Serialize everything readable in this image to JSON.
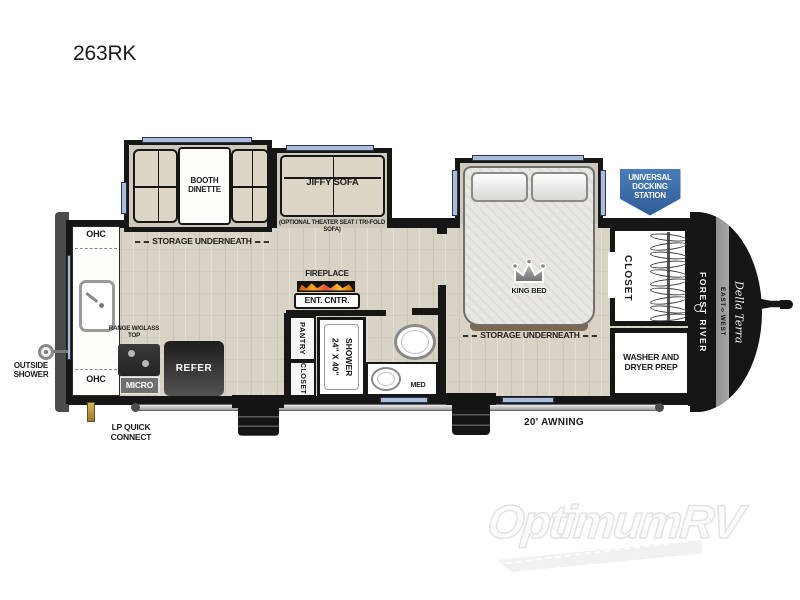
{
  "page": {
    "title": "263RK"
  },
  "watermark": {
    "brand": "OptimumRV"
  },
  "exterior": {
    "docking_station": "UNIVERSAL DOCKING STATION",
    "awning": "20' AWNING",
    "outside_shower": "OUTSIDE SHOWER",
    "lp_quick_connect": "LP QUICK CONNECT"
  },
  "living_area": {
    "booth_dinette": "BOOTH DINETTE",
    "storage_underneath": "STORAGE UNDERNEATH",
    "jiffy_sofa": "JIFFY SOFA",
    "optional_note": "(OPTIONAL THEATER SEAT / TRI-FOLD SOFA)",
    "fireplace": "FIREPLACE",
    "ent_cntr": "ENT. CNTR."
  },
  "kitchen": {
    "ohc_top": "OHC",
    "ohc_bottom": "OHC",
    "range": "RANGE W/GLASS TOP",
    "micro": "MICRO",
    "refer": "REFER"
  },
  "bathroom": {
    "pantry": "PANTRY",
    "closet": "CLOSET",
    "shower": "24\" X 40\" SHOWER",
    "med": "MED"
  },
  "bedroom": {
    "king_bed": "KING BED",
    "storage_underneath": "STORAGE UNDERNEATH",
    "closet": "CLOSET",
    "washer_dryer": "WASHER AND DRYER PREP"
  },
  "branding": {
    "manufacturer": "FOREST RIVER",
    "division": "EAST◊WEST",
    "series": "Della Terra"
  },
  "colors": {
    "badge_blue": "#3d6eac",
    "window_blue": "#a9bedf",
    "flame_orange": "#e87722",
    "wall_black": "#161616",
    "floor_tan": "#d9d3c5"
  }
}
